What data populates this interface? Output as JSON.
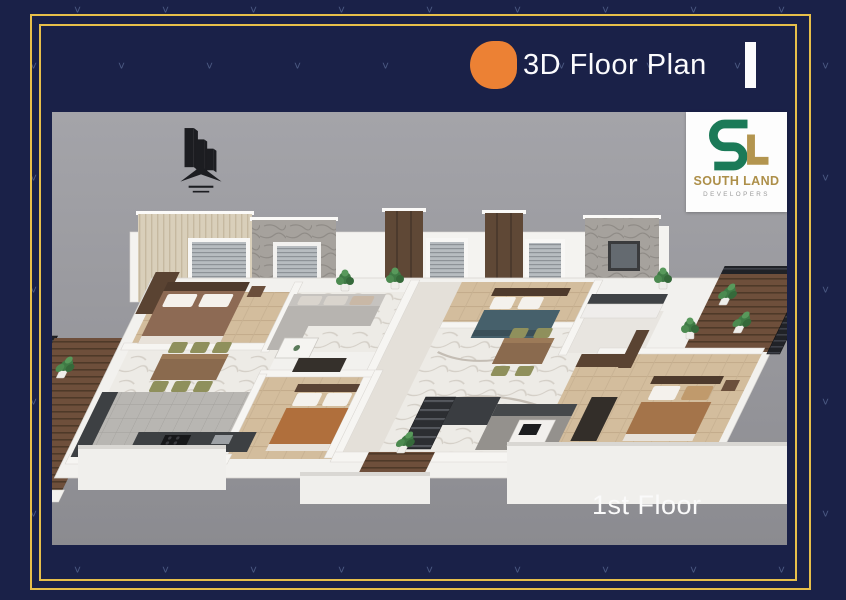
{
  "header": {
    "title": "3D Floor Plan"
  },
  "brand": {
    "name": "SOUTH LAND",
    "subtitle": "DEVELOPERS"
  },
  "canvas": {
    "floor_label": "1st Floor"
  },
  "decor": {
    "pattern_glyph": "˅"
  },
  "icons": {
    "bullet": "orange-dot-icon",
    "building_logo": "building-skyline-icon",
    "brand_monogram": "southland-sl-monogram-icon"
  },
  "colors": {
    "background_navy": "#1a2148",
    "border_gold": "#e7bf4a",
    "accent_orange": "#ec8134",
    "canvas_gray": "#9c9ca1",
    "brand_green": "#1b7a58",
    "brand_gold": "#b3954f"
  }
}
